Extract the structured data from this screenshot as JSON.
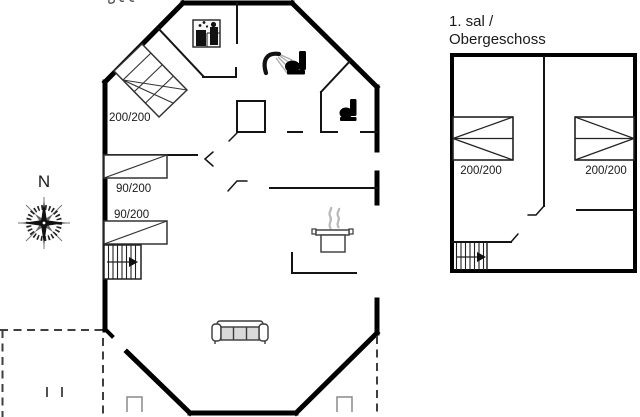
{
  "page": {
    "background_color": "#ffffff",
    "type_note": "vacation house floor plan drawing"
  },
  "main_floor": {
    "bed_double_label": "200/200",
    "bed_single_top_label": "90/200",
    "bed_single_bottom_label": "90/200",
    "icons": [
      "washing-machine-icon",
      "shower-icon",
      "toilet-icon",
      "wc-toilet-icon",
      "stove-pot-icon",
      "sofa-icon",
      "stairs-up-icon"
    ]
  },
  "upper_floor": {
    "title_line_1": "1. sal /",
    "title_line_2": "Obergeschoss",
    "bed_left_label": "200/200",
    "bed_right_label": "200/200",
    "icons": [
      "stairs-up-icon"
    ]
  },
  "compass": {
    "north_label": "N"
  },
  "colors": {
    "outer_wall": "#000000",
    "interior_wall": "#141414",
    "furniture_outline": "#3a3a3a",
    "light_gray": "#9e9e9e",
    "cushion_fill": "#d9d9d9",
    "steam_gray": "#b8b8b8",
    "dashed_terrace": "#3f3f3f",
    "text": "#1a1a1a"
  }
}
